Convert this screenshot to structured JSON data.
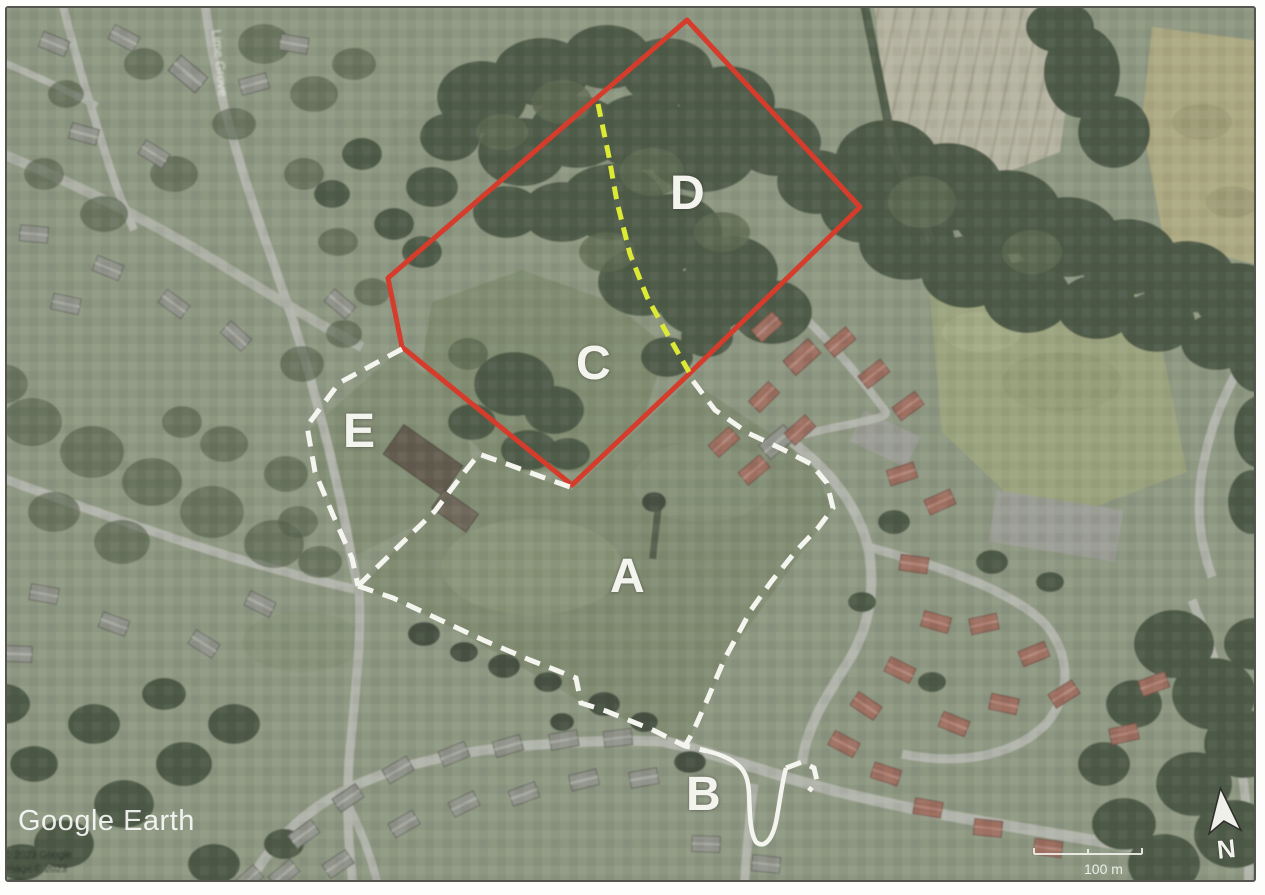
{
  "map": {
    "watermark": "Google Earth",
    "attribution_line1": "© 2023 Google",
    "attribution_line2": "Image © 2023",
    "scale_label": "100 m",
    "compass_label": "N",
    "road_label": "Lime Grove"
  },
  "area_labels": {
    "a": "A",
    "b": "B",
    "c": "C",
    "d": "D",
    "e": "E"
  },
  "annotation_colors": {
    "red_boundary": "#d63c2c",
    "yellow_divider": "#dcea35",
    "white_boundary": "#f5f5f0"
  }
}
